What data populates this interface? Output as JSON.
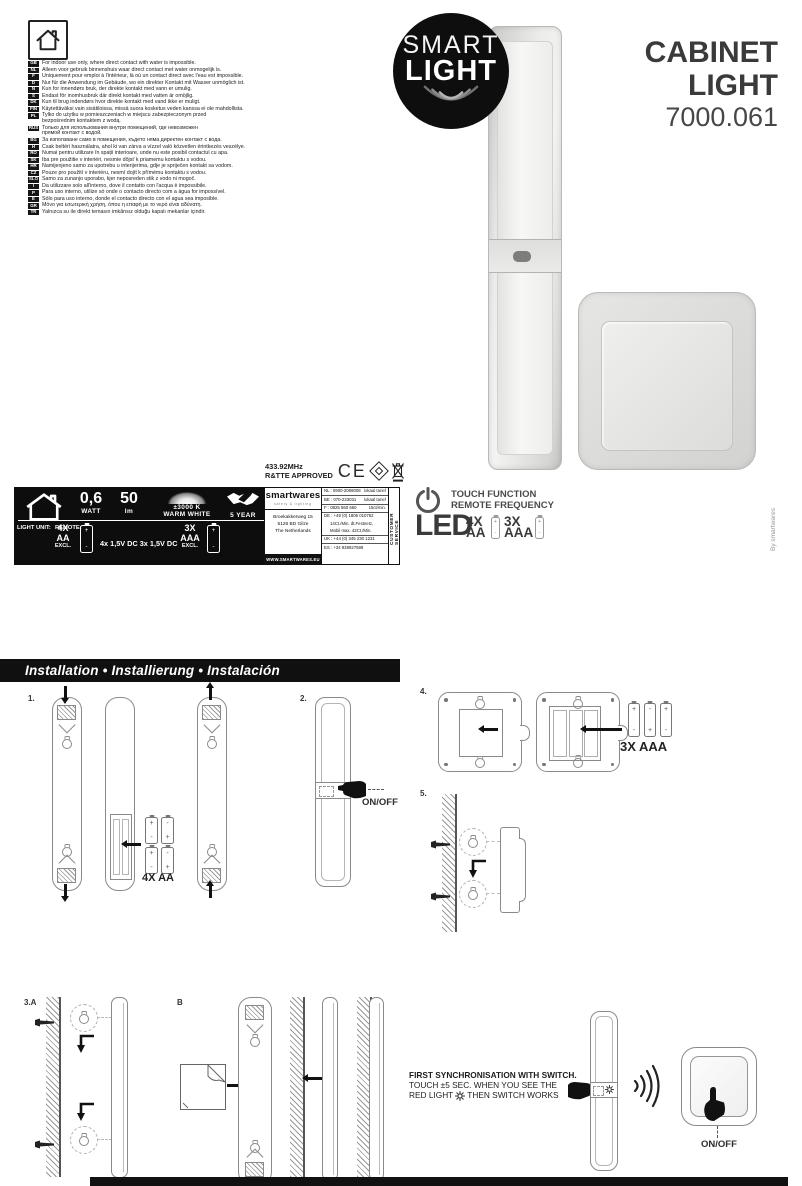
{
  "header": {
    "brand_badge": {
      "line1": "SMART",
      "line2": "LIGHT"
    },
    "title": "CABINET LIGHT",
    "model": "7000.061",
    "by_line": "By smartwares"
  },
  "languages": [
    {
      "code": "GB",
      "text": "For indoor use only, where direct contact with water is impossible."
    },
    {
      "code": "NL",
      "text": "Alleen voor gebruik binnenshuis waar direct contact met water onmogelijk is."
    },
    {
      "code": "F",
      "text": "Uniquement pour emploi à l'intérieur, là où un contact direct avec l'eau est impossible."
    },
    {
      "code": "D",
      "text": "Nur für die Anwendung im Gebäude, wo ein direkter Kontakt mit Wasser unmöglich ist."
    },
    {
      "code": "N",
      "text": "Kun for innendørs bruk, der direkte kontakt med vann er umulig."
    },
    {
      "code": "S",
      "text": "Endast för inomhusbruk där direkt kontakt med vatten är omöjlig."
    },
    {
      "code": "DK",
      "text": "Kun til brug indendørs hvor direkte kontakt med vand ikke er muligt."
    },
    {
      "code": "FIN",
      "text": "Käytettäväksi vain sisätiloissa, missä suora kosketus veden kanssa ei ole mahdollista."
    },
    {
      "code": "PL",
      "text": "Tylko do użytku w pomieszczeniach w miejscu zabezpieczonym przed\nbezpośrednim kontaktem z wodą."
    },
    {
      "code": "RUS",
      "text": "Только для использования внутри помещений, где невозможен\nпрямой контакт с водой."
    },
    {
      "code": "BG",
      "text": "За използване само в помещения, където няма директен контакт с вода."
    },
    {
      "code": "H",
      "text": "Csak beltéri használatra, ahol ki van zárva a vízzel való közvetlen érintkezés veszélye."
    },
    {
      "code": "RO",
      "text": "Numai pentru utilizare în spații interioare, unde nu este posibil contactul cu apa."
    },
    {
      "code": "SK",
      "text": "Iba pre použitie v interiéri, nesmie dôjsť k priamemu kontaktu s vodou."
    },
    {
      "code": "HR",
      "text": "Namijenjeno samo za upotrebu u interijerima, gdje je spriječen kontakt sa vodom."
    },
    {
      "code": "CZ",
      "text": "Pouze pro použití v interiéru, nesmí dojít k přímému kontaktu s vodou."
    },
    {
      "code": "SLO",
      "text": "Samo za zunanjo uporabo, kjer neposreden stik z vodo ni mogoč."
    },
    {
      "code": "I",
      "text": "Da utilizzare solo all'interno, dove il contatto con l'acqua è impossibile."
    },
    {
      "code": "P",
      "text": "Para uso interno, utilize só onde o contacto directo com a água for impossível."
    },
    {
      "code": "E",
      "text": "Sólo para uso interno, donde el contacto directo con el agua sea imposible."
    },
    {
      "code": "GR",
      "text": "Μόνο για εσωτερική χρήση, όπου η επαφή με το νερό είναι αδύνατη."
    },
    {
      "code": "TR",
      "text": "Yalnızca su ile direkt temasın imkânsız olduğu kapalı mekanlar içindir."
    }
  ],
  "approval": {
    "freq": "433.92MHz",
    "rtte": "R&TTE APPROVED",
    "ce": "CE"
  },
  "specs": {
    "watt_value": "0,6",
    "watt_label": "WATT",
    "lumen_value": "50",
    "lumen_label": "lm",
    "color_temp": "±3000 K",
    "color_label": "WARM WHITE",
    "warranty": "5 YEAR",
    "light_unit": "LIGHT UNIT:",
    "remote": "REMOTE:",
    "c1": "4X",
    "t1": "AA",
    "e1": "EXCL.",
    "voltage": "4x 1,5V DC 3x 1,5V DC",
    "c2": "3X",
    "t2": "AAA",
    "e2": "EXCL."
  },
  "contact": {
    "brand": "smartwares",
    "brand_sub": "safety & lighting",
    "addr1": "Broekakkerweg 15",
    "addr2": "5126 BD  Gilze",
    "addr3": "The Netherlands",
    "website": "WWW.SMARTWARES.EU",
    "customer_service": "CUSTOMER SERVICE",
    "phones": [
      {
        "c": "NL",
        "n": "0900-2088008",
        "note": "lokaal  tarief",
        "border": true
      },
      {
        "c": "BE",
        "n": "070-233031",
        "note": "lokaal  tarief",
        "border": true
      },
      {
        "c": "F",
        "n": "0825 560 660",
        "note": "15ct/min.",
        "border": true
      },
      {
        "c": "DE",
        "n": "+49 (0) 1805 010762",
        "note": "",
        "border": false
      },
      {
        "c": "",
        "n": "14Ct./Min. dt.Festnetz,",
        "note": "",
        "border": false
      },
      {
        "c": "",
        "n": "Mobil max. 42Ct./Min.",
        "note": "",
        "border": true
      },
      {
        "c": "UK",
        "n": "+44 (0) 345 230 1231",
        "note": "",
        "border": true
      },
      {
        "c": "ES",
        "n": "+34 938927589",
        "note": "",
        "border": false
      }
    ]
  },
  "features": {
    "touch": "TOUCH FUNCTION",
    "remote": "REMOTE FREQUENCY",
    "led": "LED",
    "b1a": "4X",
    "b1b": "AA",
    "b2a": "3X",
    "b2b": "AAA"
  },
  "install": {
    "heading": "Installation • Installierung • Instalación",
    "steps": {
      "s1": "1.",
      "s2": "2.",
      "s3a": "3.A",
      "sb": "B",
      "s4": "4.",
      "s5": "5."
    },
    "batt_aa": "4X AA",
    "batt_aaa": "3X AAA",
    "onoff1": "ON/OFF",
    "onoff2": "ON/OFF",
    "sync1": "FIRST SYNCHRONISATION WITH SWITCH.",
    "sync2": "TOUCH ±5 SEC. WHEN YOU SEE THE",
    "sync3a": "RED LIGHT",
    "sync3b": "THEN SWITCH WORKS"
  },
  "cells": {
    "aa": [
      [
        "+",
        "-"
      ],
      [
        "-",
        "+"
      ],
      [
        "+",
        "-"
      ],
      [
        "-",
        "+"
      ]
    ],
    "aaa": [
      [
        "+",
        "-"
      ],
      [
        "-",
        "+"
      ],
      [
        "+",
        "-"
      ]
    ],
    "single": [
      [
        "+",
        "-"
      ]
    ]
  },
  "colors": {
    "ink": "#111111",
    "product_gray": "#d9d9d7"
  }
}
